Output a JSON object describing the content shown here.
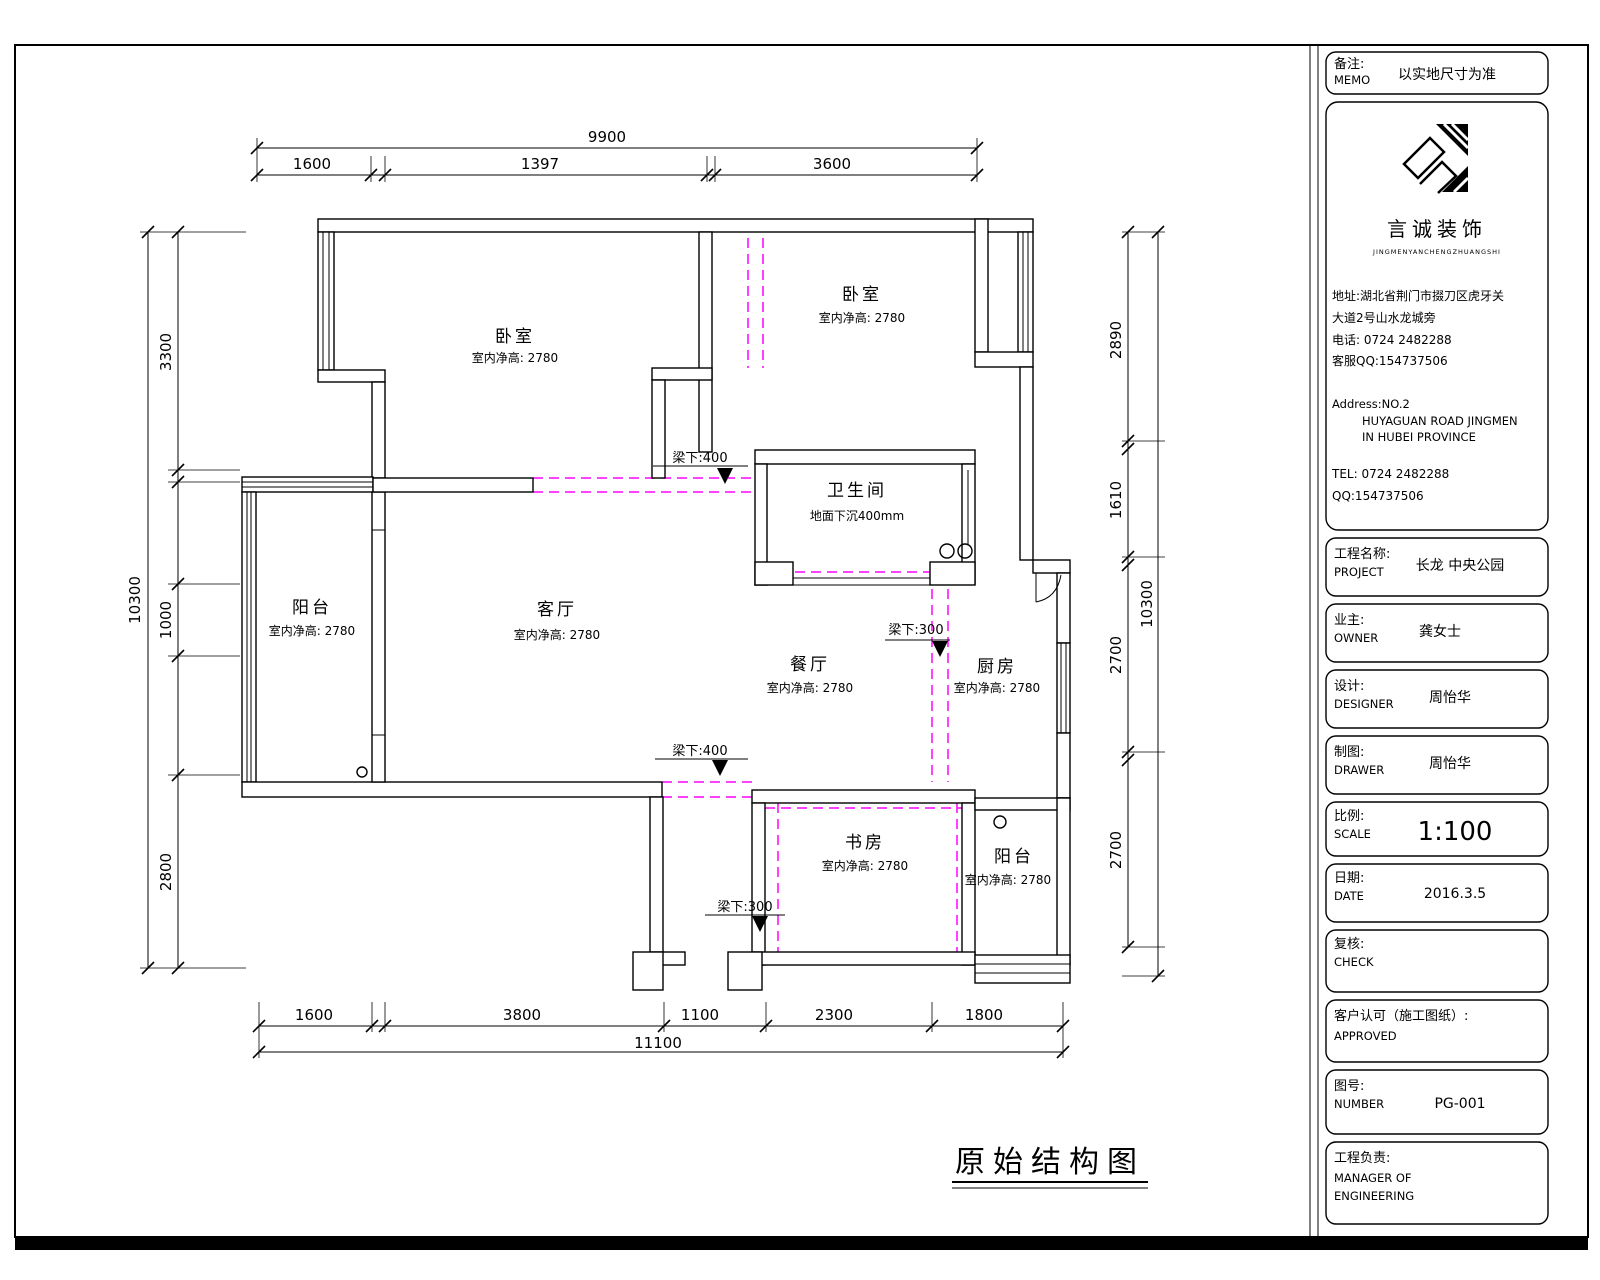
{
  "colors": {
    "line": "#000000",
    "beam": "#ff00ff",
    "paper": "#ffffff"
  },
  "sheet_title": "原始结构图",
  "rooms": {
    "bedroom1": {
      "name": "卧室",
      "height": "室内净高: 2780"
    },
    "bedroom2": {
      "name": "卧室",
      "height": "室内净高: 2780"
    },
    "bathroom": {
      "name": "卫生间",
      "note": "地面下沉400mm"
    },
    "balcony_left": {
      "name": "阳台",
      "height": "室内净高: 2780"
    },
    "living": {
      "name": "客厅",
      "height": "室内净高: 2780"
    },
    "dining": {
      "name": "餐厅",
      "height": "室内净高: 2780"
    },
    "kitchen": {
      "name": "厨房",
      "height": "室内净高: 2780"
    },
    "study": {
      "name": "书房",
      "height": "室内净高: 2780"
    },
    "balcony_right": {
      "name": "阳台",
      "height": "室内净高: 2780"
    }
  },
  "beams": {
    "b400_top": "梁下:400",
    "b300_mid": "梁下:300",
    "b400_bottom": "梁下:400",
    "b300_bottom": "梁下:300"
  },
  "dims": {
    "top": {
      "overall": "9900",
      "segments": [
        "1600",
        "1397",
        "3600"
      ]
    },
    "bottom": {
      "overall": "11100",
      "segments": [
        "1600",
        "3800",
        "1100",
        "2300",
        "1800"
      ]
    },
    "left": {
      "overall": "10300",
      "segments": [
        "3300",
        "1000",
        "2800"
      ]
    },
    "right": {
      "overall": "10300",
      "segments": [
        "2890",
        "1610",
        "2700",
        "2700"
      ]
    }
  },
  "titleblock": {
    "memo": {
      "cn": "备注:",
      "en": "MEMO",
      "value": "以实地尺寸为准"
    },
    "company": {
      "name": "言诚装饰",
      "tagline": "JINGMENYANCHENGZHUANGSHI",
      "addr_cn1": "地址:湖北省荆门市掇刀区虎牙关",
      "addr_cn2": "大道2号山水龙城旁",
      "phone_cn": "电话: 0724 2482288",
      "qq_cn": "客服QQ:154737506",
      "addr_en1": "Address:NO.2",
      "addr_en2": "HUYAGUAN ROAD JINGMEN",
      "addr_en3": "IN HUBEI PROVINCE",
      "tel_en": "TEL: 0724 2482288",
      "qq_en": "QQ:154737506"
    },
    "project": {
      "cn": "工程名称:",
      "en": "PROJECT",
      "value": "长龙 中央公园"
    },
    "owner": {
      "cn": "业主:",
      "en": "OWNER",
      "value": "龚女士"
    },
    "designer": {
      "cn": "设计:",
      "en": "DESIGNER",
      "value": "周怡华"
    },
    "drawer": {
      "cn": "制图:",
      "en": "DRAWER",
      "value": "周怡华"
    },
    "scale": {
      "cn": "比例:",
      "en": "SCALE",
      "value": "1:100"
    },
    "date": {
      "cn": "日期:",
      "en": "DATE",
      "value": "2016.3.5"
    },
    "check": {
      "cn": "复核:",
      "en": "CHECK"
    },
    "approved": {
      "cn": "客户认可（施工图纸）:",
      "en": "APPROVED"
    },
    "number": {
      "cn": "图号:",
      "en": "NUMBER",
      "value": "PG-001"
    },
    "manager": {
      "cn": "工程负责:",
      "en1": "MANAGER OF",
      "en2": "ENGINEERING"
    }
  }
}
